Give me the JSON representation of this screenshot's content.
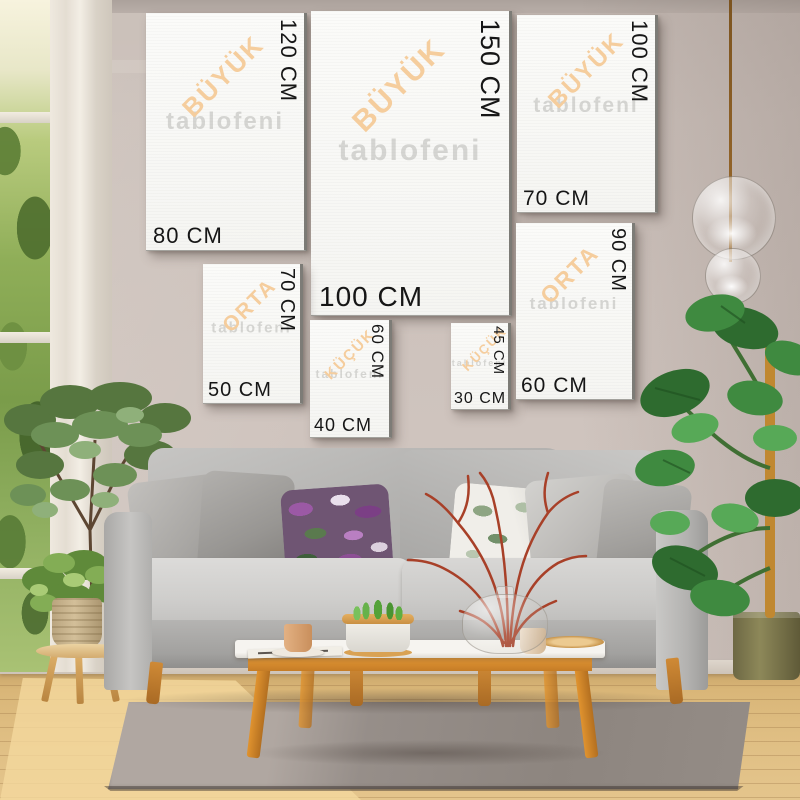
{
  "watermark": "tablofeni",
  "frames": [
    {
      "size": "80x120",
      "category": "BÜYÜK",
      "width_label": "80 CM",
      "height_label": "120 CM"
    },
    {
      "size": "100x150",
      "category": "BÜYÜK",
      "width_label": "100 CM",
      "height_label": "150 CM"
    },
    {
      "size": "70x100",
      "category": "BÜYÜK",
      "width_label": "70 CM",
      "height_label": "100 CM"
    },
    {
      "size": "50x70",
      "category": "ORTA",
      "width_label": "50 CM",
      "height_label": "70 CM"
    },
    {
      "size": "40x60",
      "category": "KÜÇÜK",
      "width_label": "40 CM",
      "height_label": "60 CM"
    },
    {
      "size": "30x45",
      "category": "KÜÇÜK",
      "width_label": "30 CM",
      "height_label": "45 CM"
    },
    {
      "size": "60x90",
      "category": "ORTA",
      "width_label": "60 CM",
      "height_label": "90 CM"
    }
  ],
  "colors": {
    "category_label": "#f5cd9d",
    "dimension_text": "#161616",
    "canvas": "#f9f9f7",
    "wall": "#c9beb8",
    "wood_accent": "#dd9333",
    "sofa": "#c6c5c3",
    "rug": "#97908b",
    "floor": "#ddbc81"
  }
}
